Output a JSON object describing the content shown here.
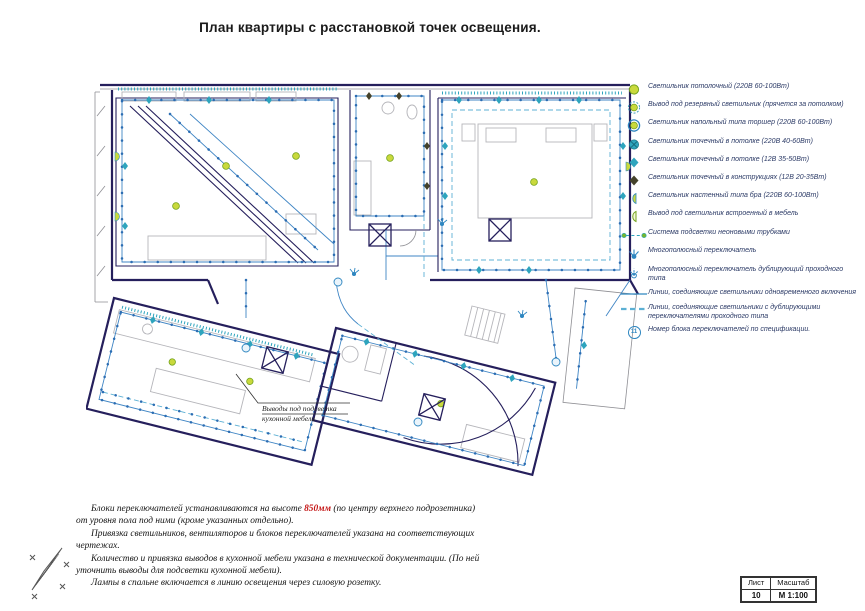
{
  "page": {
    "title": "План квартиры с расстановкой точек освещения."
  },
  "legend": {
    "items": [
      {
        "icon": "ceiling-lamp-icon",
        "label": "Светильник потолочный (220В  60-100Вт)"
      },
      {
        "icon": "reserve-lamp-icon",
        "label": "Вывод под резервный светильник (прячется за потолком)"
      },
      {
        "icon": "floor-lamp-icon",
        "label": "Светильник напольный типа торшер (220В  60-100Вт)"
      },
      {
        "icon": "spot-ceiling-220-icon",
        "label": "Светильник точечный в потолке (220В  40-60Вт)"
      },
      {
        "icon": "spot-ceiling-12-icon",
        "label": "Светильник точечный в потолке (12В  35-50Вт)"
      },
      {
        "icon": "spot-construction-icon",
        "label": "Светильник точечный в конструкциях (12В  20-35Вт)"
      },
      {
        "icon": "wall-sconce-icon",
        "label": "Светильник настенный типа бра (220В  60-100Вт)"
      },
      {
        "icon": "furniture-lamp-icon",
        "label": "Вывод под светильник встроенный в мебель"
      },
      {
        "icon": "neon-tube-icon",
        "label": "Система подсветки неоновыми трубками"
      },
      {
        "icon": "multipole-switch-icon",
        "label": "Многополюсный переключатель"
      },
      {
        "icon": "multipole-switch-pass-icon",
        "label": "Многополюсный переключатель дублирующий проходного типа"
      },
      {
        "icon": "simultaneous-line-icon",
        "label": "Линии, соединяющие светильники одновременного включения"
      },
      {
        "icon": "duplicate-line-icon",
        "label": "Линии, соединяющие светильники с дублирующими переключателями проходного типа"
      },
      {
        "icon": "switch-block-number-icon",
        "label": "Номер блока переключателей по спецификации.",
        "badge": "11"
      }
    ]
  },
  "plan": {
    "annotation": {
      "line1": "Выводы под подсветка",
      "line2": "кухонной мебели"
    }
  },
  "notes": {
    "p1_before": "Блоки переключателей устанавливаются на высоте ",
    "p1_red": "850мм",
    "p1_after": " (по центру верхнего подрозетника) от уровня пола под ними (кроме указанных отдельно).",
    "p2": "Привязка светильников, вентиляторов и блоков переключателей указана на соответствующих  чертежах.",
    "p3": "Количество и привязка выводов в кухонной мебели указана в технической документации. (По ней уточнить выводы для подсветки кухонной мебели).",
    "p4": "Лампы  в спальне включается в линию освещения через силовую розетку."
  },
  "title_block": {
    "sheet_label": "Лист",
    "scale_label": "Масштаб",
    "sheet_value": "10",
    "scale_value": "М 1:100"
  },
  "colors": {
    "wall_navy": "#251f5c",
    "accent_blue": "#3f85c4",
    "teal": "#2ea4bd",
    "lamp_green": "#c9d93c",
    "note_red": "#c41414"
  }
}
